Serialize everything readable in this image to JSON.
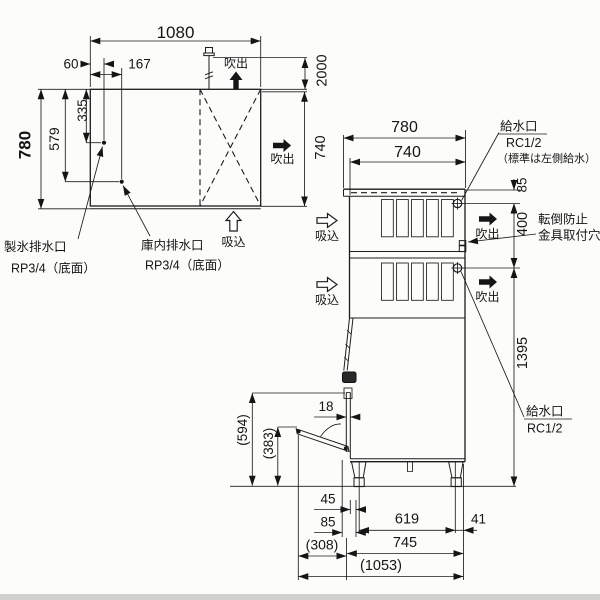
{
  "labels": {
    "blowout": "吹出",
    "intake": "吸込"
  },
  "top_view": {
    "width": "1080",
    "drain1_x": "60",
    "drain2_x": "167",
    "depth": "780",
    "drain2_y": "579",
    "drain1_y": "335",
    "anchor_height": "2000",
    "unit_depth": "740",
    "ice_drain": "製氷排水口",
    "ice_drain_spec": "RP3/4（底面）",
    "bin_drain": "庫内排水口",
    "bin_drain_spec": "RP3/4（底面）"
  },
  "side_view": {
    "depth_total": "780",
    "depth_body": "740",
    "inlet_top": "給水口",
    "inlet_top_spec": "RC1/2",
    "inlet_top_note": "（標準は左側給水）",
    "inlet_drop": "85",
    "inlet_spacing": "400",
    "tipover_line1": "転倒防止",
    "tipover_line2": "金具取付穴",
    "inlet_height": "1395",
    "inlet_bottom": "給水口",
    "inlet_bottom_spec": "RC1/2",
    "door_thickness": "18",
    "door_top_height": "(594)",
    "door_open_height": "(383)",
    "leg_offset": "45",
    "front_offset": "85",
    "door_projection": "(308)",
    "leg_pitch": "619",
    "rear_offset": "41",
    "base_depth": "745",
    "total_depth": "(1053)"
  }
}
